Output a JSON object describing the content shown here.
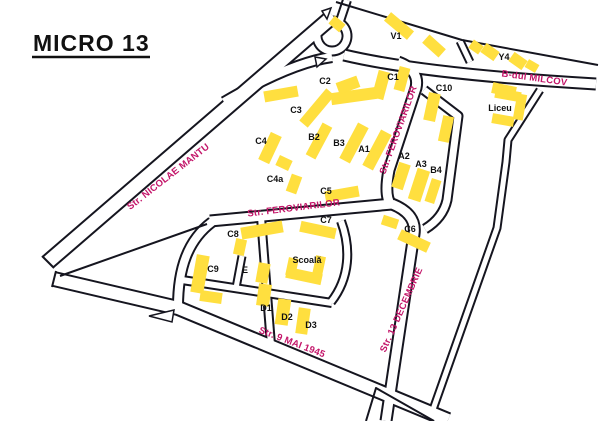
{
  "title": "MICRO 13",
  "colors": {
    "background": "#FFFFFF",
    "road_line": "#15151F",
    "road_fill": "#FFFFFF",
    "building": "#FFDF3F",
    "building_label": "#111111",
    "street_label": "#C31569",
    "title_color": "#111111"
  },
  "map": {
    "roads": [
      {
        "id": "nicolae-mantu",
        "d": "M 333,16 L 48,262",
        "w": 17
      },
      {
        "id": "top-connector",
        "d": "M 224,102 Q 290,63 332,57",
        "w": 12
      },
      {
        "id": "bdul-milcov",
        "d": "M 344,55 Q 424,74 596,84",
        "w": 13
      },
      {
        "id": "roundabout",
        "d": "M 332,21 a 15,15 0 1 0 0.01,0 Z",
        "w": 11
      },
      {
        "id": "north-stub",
        "d": "M 340,21 L 347,0",
        "w": 10
      },
      {
        "id": "feroviarilor-vertical",
        "d": "M 398,62 Q 420,70 416,88 L 389,170 Q 384,196 391,205",
        "w": 13
      },
      {
        "id": "feroviarilor-horizontal",
        "d": "M 210,221 L 392,204",
        "w": 13
      },
      {
        "id": "west-wrap",
        "d": "M 212,222 C 188,240 178,268 178,307",
        "w": 12
      },
      {
        "id": "str-9-mai",
        "d": "M 54,279 L 178,308 L 448,420",
        "w": 16
      },
      {
        "id": "str-13-decembrie",
        "d": "M 392,204 Q 417,214 414,234 L 386,421",
        "w": 13
      },
      {
        "id": "v1-y4-divider",
        "d": "M 460,41 L 470,62",
        "w": 9
      },
      {
        "id": "east-road",
        "d": "M 540,90 L 508,140 L 506,162 L 497,228 L 430,418",
        "w": 9
      },
      {
        "id": "a-block-loop",
        "d": "M 424,90 L 458,116 L 447,200 Q 443,218 425,229",
        "w": 11
      },
      {
        "id": "school-street-vertical",
        "d": "M 261,217 L 271,345",
        "w": 10
      },
      {
        "id": "school-street-horizontal",
        "d": "M 182,280 L 332,303",
        "w": 10
      },
      {
        "id": "school-street-stub",
        "d": "M 236,288 L 242,256",
        "w": 9
      },
      {
        "id": "school-street-east",
        "d": "M 341,221 C 351,248 350,278 331,302",
        "w": 10
      }
    ],
    "boundaries": [
      {
        "id": "north-edge",
        "d": "M 336,2 L 462,40 L 598,65"
      },
      {
        "id": "sliver-edge",
        "d": "M 60,276 L 207,224"
      },
      {
        "id": "south-corner",
        "d": "M 366,421 L 376,388 L 434,421"
      },
      {
        "id": "mantu-end-cap",
        "d": "M 42,256 L 54,268"
      },
      {
        "id": "mai-west-cap",
        "d": "M 52,287 L 56,271"
      }
    ],
    "islands": [
      {
        "points": "322,11 331,8 327,19"
      },
      {
        "points": "315,57 326,59 317,67"
      },
      {
        "points": "149,316 174,310 172,322"
      }
    ],
    "buildings": [
      {
        "x": 337,
        "y": 24,
        "w": 14,
        "h": 10,
        "rot": 40
      },
      {
        "x": 399,
        "y": 26,
        "w": 30,
        "h": 11,
        "rot": 40
      },
      {
        "x": 434,
        "y": 46,
        "w": 22,
        "h": 11,
        "rot": 42
      },
      {
        "x": 476,
        "y": 47,
        "w": 12,
        "h": 10,
        "rot": 35
      },
      {
        "x": 490,
        "y": 52,
        "w": 16,
        "h": 11,
        "rot": 35
      },
      {
        "x": 518,
        "y": 61,
        "w": 16,
        "h": 11,
        "rot": 35
      },
      {
        "x": 532,
        "y": 66,
        "w": 12,
        "h": 9,
        "rot": 30
      },
      {
        "x": 281,
        "y": 94,
        "w": 34,
        "h": 11,
        "rot": -10
      },
      {
        "x": 354,
        "y": 96,
        "w": 46,
        "h": 12,
        "rot": -8
      },
      {
        "x": 348,
        "y": 85,
        "w": 22,
        "h": 12,
        "rot": -20
      },
      {
        "x": 381,
        "y": 85,
        "w": 12,
        "h": 28,
        "rot": 15
      },
      {
        "x": 402,
        "y": 79,
        "w": 11,
        "h": 24,
        "rot": 15
      },
      {
        "x": 432,
        "y": 107,
        "w": 12,
        "h": 28,
        "rot": 12
      },
      {
        "x": 446,
        "y": 129,
        "w": 11,
        "h": 26,
        "rot": 12
      },
      {
        "x": 504,
        "y": 90,
        "w": 24,
        "h": 11,
        "rot": 12
      },
      {
        "x": 317,
        "y": 108,
        "w": 11,
        "h": 42,
        "rot": 40
      },
      {
        "x": 270,
        "y": 148,
        "w": 12,
        "h": 30,
        "rot": 25
      },
      {
        "x": 284,
        "y": 163,
        "w": 14,
        "h": 11,
        "rot": 25
      },
      {
        "x": 294,
        "y": 184,
        "w": 11,
        "h": 18,
        "rot": 20
      },
      {
        "x": 319,
        "y": 141,
        "w": 11,
        "h": 36,
        "rot": 28
      },
      {
        "x": 354,
        "y": 143,
        "w": 12,
        "h": 40,
        "rot": 28
      },
      {
        "x": 377,
        "y": 150,
        "w": 12,
        "h": 40,
        "rot": 28
      },
      {
        "x": 401,
        "y": 176,
        "w": 12,
        "h": 26,
        "rot": 18
      },
      {
        "x": 419,
        "y": 185,
        "w": 13,
        "h": 32,
        "rot": 18
      },
      {
        "x": 433,
        "y": 191,
        "w": 10,
        "h": 24,
        "rot": 18
      },
      {
        "x": 342,
        "y": 194,
        "w": 34,
        "h": 11,
        "rot": -10
      },
      {
        "x": 414,
        "y": 241,
        "w": 32,
        "h": 11,
        "rot": 25
      },
      {
        "x": 390,
        "y": 222,
        "w": 16,
        "h": 10,
        "rot": 18
      },
      {
        "x": 318,
        "y": 230,
        "w": 36,
        "h": 11,
        "rot": 12
      },
      {
        "x": 262,
        "y": 230,
        "w": 42,
        "h": 12,
        "rot": -10
      },
      {
        "x": 240,
        "y": 247,
        "w": 11,
        "h": 16,
        "rot": 12
      },
      {
        "x": 200,
        "y": 274,
        "w": 13,
        "h": 38,
        "rot": 10
      },
      {
        "x": 211,
        "y": 297,
        "w": 22,
        "h": 11,
        "rot": 8
      },
      {
        "x": 263,
        "y": 273,
        "w": 12,
        "h": 20,
        "rot": 10
      },
      {
        "x": 292,
        "y": 267,
        "w": 10,
        "h": 18,
        "rot": 12
      },
      {
        "x": 304,
        "y": 276,
        "w": 36,
        "h": 11,
        "rot": 12
      },
      {
        "x": 319,
        "y": 266,
        "w": 10,
        "h": 20,
        "rot": 12
      },
      {
        "x": 264,
        "y": 295,
        "w": 13,
        "h": 22,
        "rot": 8
      },
      {
        "x": 283,
        "y": 312,
        "w": 13,
        "h": 26,
        "rot": 8
      },
      {
        "x": 303,
        "y": 321,
        "w": 12,
        "h": 26,
        "rot": 8
      },
      {
        "x": 508,
        "y": 95,
        "w": 26,
        "h": 10,
        "rot": 10
      },
      {
        "x": 520,
        "y": 107,
        "w": 10,
        "h": 26,
        "rot": 10
      },
      {
        "x": 503,
        "y": 120,
        "w": 22,
        "h": 10,
        "rot": 10
      }
    ],
    "building_labels": [
      {
        "text": "V1",
        "x": 396,
        "y": 36
      },
      {
        "text": "Y4",
        "x": 504,
        "y": 57
      },
      {
        "text": "C1",
        "x": 393,
        "y": 77
      },
      {
        "text": "C2",
        "x": 325,
        "y": 81
      },
      {
        "text": "C3",
        "x": 296,
        "y": 110
      },
      {
        "text": "C10",
        "x": 444,
        "y": 88
      },
      {
        "text": "C4",
        "x": 261,
        "y": 141
      },
      {
        "text": "C4a",
        "x": 275,
        "y": 179
      },
      {
        "text": "B2",
        "x": 314,
        "y": 137
      },
      {
        "text": "B3",
        "x": 339,
        "y": 143
      },
      {
        "text": "A1",
        "x": 364,
        "y": 149
      },
      {
        "text": "A2",
        "x": 404,
        "y": 156
      },
      {
        "text": "A3",
        "x": 421,
        "y": 164
      },
      {
        "text": "B4",
        "x": 436,
        "y": 170
      },
      {
        "text": "C5",
        "x": 326,
        "y": 191
      },
      {
        "text": "C6",
        "x": 410,
        "y": 229
      },
      {
        "text": "C7",
        "x": 326,
        "y": 220
      },
      {
        "text": "C8",
        "x": 233,
        "y": 234
      },
      {
        "text": "C9",
        "x": 213,
        "y": 269
      },
      {
        "text": "E",
        "x": 245,
        "y": 270
      },
      {
        "text": "D1",
        "x": 266,
        "y": 308
      },
      {
        "text": "D2",
        "x": 287,
        "y": 317
      },
      {
        "text": "D3",
        "x": 311,
        "y": 325
      },
      {
        "text": "Scoală",
        "x": 307,
        "y": 260
      },
      {
        "text": "Liceu",
        "x": 500,
        "y": 108
      }
    ],
    "street_labels": [
      {
        "text": "Str. NICOLAE MANTU",
        "x": 170,
        "y": 179,
        "rot": -38
      },
      {
        "text": "B-dul MILCOV",
        "x": 534,
        "y": 81,
        "rot": 8
      },
      {
        "text": "Str. FEROVIARILOR",
        "x": 401,
        "y": 131,
        "rot": -70
      },
      {
        "text": "Str. FEROVIARILOR",
        "x": 294,
        "y": 211,
        "rot": -7
      },
      {
        "text": "Str. 13 DECEMBRIE",
        "x": 404,
        "y": 311,
        "rot": -66
      },
      {
        "text": "Str. 9 MAI 1945",
        "x": 291,
        "y": 345,
        "rot": 21
      }
    ]
  }
}
